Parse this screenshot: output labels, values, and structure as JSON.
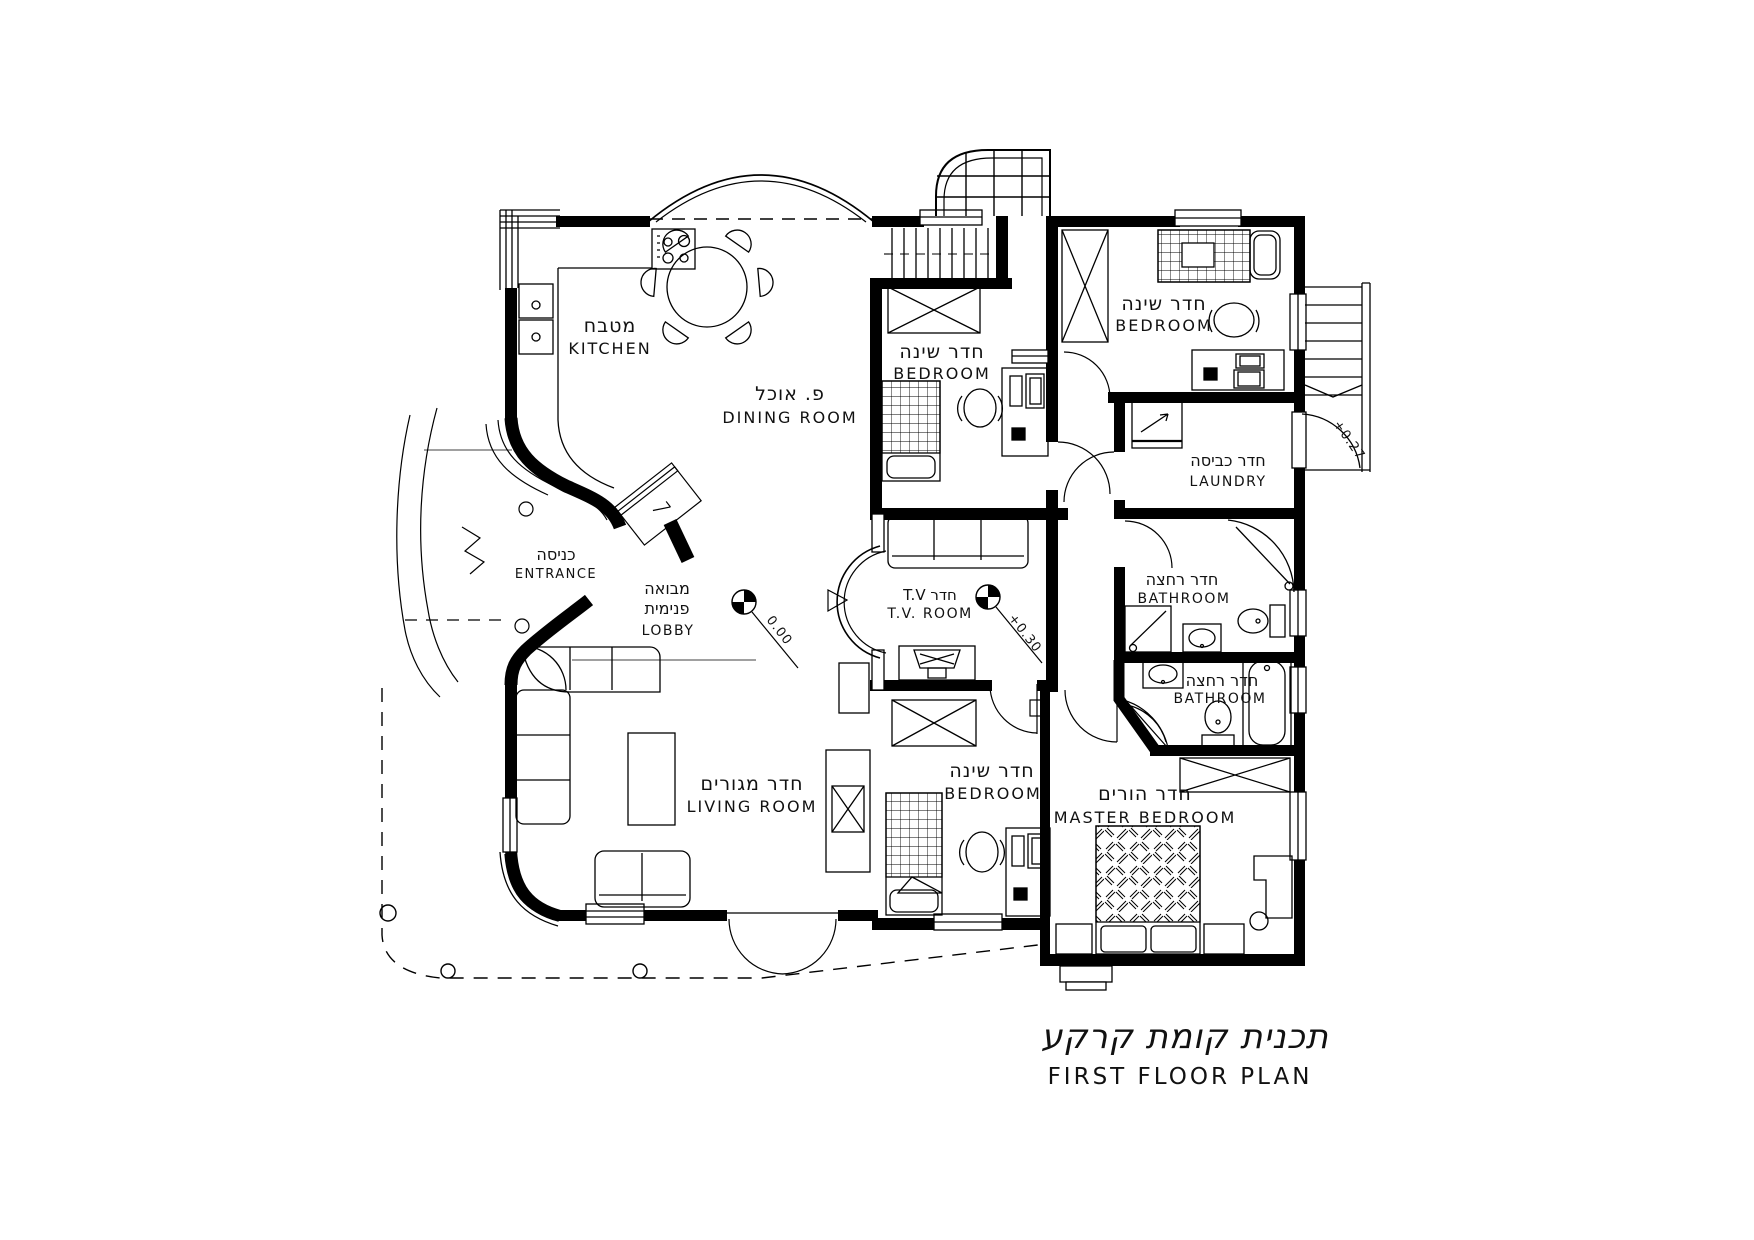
{
  "drawing": {
    "title": {
      "he": "תכנית קומת קרקע",
      "en": "FIRST FLOOR PLAN"
    },
    "rooms": {
      "kitchen": {
        "he": "מטבח",
        "en": "KITCHEN"
      },
      "dining_room": {
        "he": "פ. אוכל",
        "en": "DINING ROOM"
      },
      "bedroom_mid": {
        "he": "חדר שינה",
        "en": "BEDROOM"
      },
      "bedroom_top_right": {
        "he": "חדר שינה",
        "en": "BEDROOM"
      },
      "laundry": {
        "he": "חדר כביסה",
        "en": "LAUNDRY"
      },
      "bathroom_upper": {
        "he": "חדר רחצה",
        "en": "BATHROOM"
      },
      "bathroom_lower": {
        "he": "חדר רחצה",
        "en": "BATHROOM"
      },
      "entrance": {
        "he": "כניסה",
        "en": "ENTRANCE"
      },
      "lobby": {
        "he1": "מבואה",
        "he2": "פנימית",
        "en": "LOBBY"
      },
      "tv_room": {
        "he": "T.V חדר",
        "en": "T.V.  ROOM"
      },
      "living_room": {
        "he": "חדר מגורים",
        "en": "LIVING  ROOM"
      },
      "bedroom_bottom": {
        "he": "חדר שינה",
        "en": "BEDROOM"
      },
      "master_bedroom": {
        "he": "חדר הורים",
        "en": "MASTER  BEDROOM"
      }
    },
    "elevations": {
      "entry_level": "0.00",
      "tv_room_level": "+0.30",
      "stair_landing": "+0.27"
    },
    "ink_color": "#000000",
    "paper_color": "#ffffff"
  }
}
